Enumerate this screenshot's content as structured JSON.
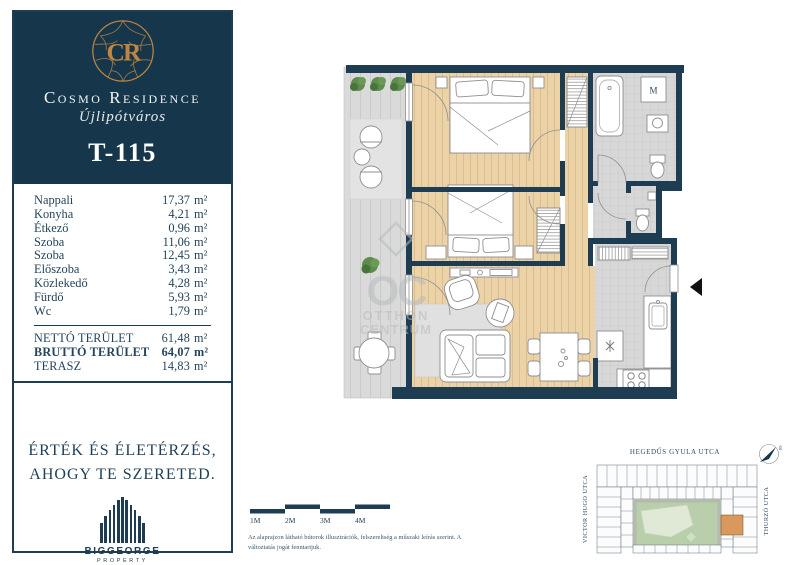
{
  "brand": {
    "monogram": "CR",
    "name": "Cosmo Residence",
    "district": "Újlipótváros"
  },
  "unit": {
    "id": "T-115"
  },
  "rooms": [
    {
      "name": "Nappali",
      "value": "17,37",
      "unit": "m²"
    },
    {
      "name": "Konyha",
      "value": "4,21",
      "unit": "m²"
    },
    {
      "name": "Étkező",
      "value": "0,96",
      "unit": "m²"
    },
    {
      "name": "Szoba",
      "value": "11,06",
      "unit": "m²"
    },
    {
      "name": "Szoba",
      "value": "12,45",
      "unit": "m²"
    },
    {
      "name": "Előszoba",
      "value": "3,43",
      "unit": "m²"
    },
    {
      "name": "Közlekedő",
      "value": "4,28",
      "unit": "m²"
    },
    {
      "name": "Fürdő",
      "value": "5,93",
      "unit": "m²"
    },
    {
      "name": "Wc",
      "value": "1,79",
      "unit": "m²"
    }
  ],
  "totals": [
    {
      "label": "NETTÓ TERÜLET",
      "value": "61,48",
      "unit": "m²"
    },
    {
      "label": "BRUTTÓ TERÜLET",
      "value": "64,07",
      "unit": "m²"
    },
    {
      "label": "TERASZ",
      "value": "14,83",
      "unit": "m²"
    }
  ],
  "tagline": {
    "line1": "ÉRTÉK ÉS ÉLETÉRZÉS,",
    "line2": "AHOGY TE SZERETED."
  },
  "developer": {
    "name": "BIGGEORGE",
    "sub": "PROPERTY"
  },
  "plan": {
    "washer_label": "M",
    "watermark": {
      "monogram": "OC",
      "line1": "OTTHON",
      "line2": "CENTRUM"
    }
  },
  "scalebar": {
    "labels": [
      "1M",
      "2M",
      "3M",
      "4M"
    ]
  },
  "disclaimer": {
    "text": "Az alaprajzon látható bútorok illusztrációk, felszereltség a műszaki leírás szerint. A változtatás jogát fenntartjuk."
  },
  "sitemap": {
    "street_top": "HEGEDŰS GYULA UTCA",
    "street_left": "VICTOR HUGO UTCA",
    "street_right": "THURZÓ UTCA",
    "compass_label": "É"
  },
  "colors": {
    "navy": "#16374b",
    "gold": "#c0853f",
    "wood": "#ecd2a7",
    "tile": "#d7d7d7",
    "courtyard_green": "#b9cfab",
    "unit_highlight": "#d9995c"
  }
}
